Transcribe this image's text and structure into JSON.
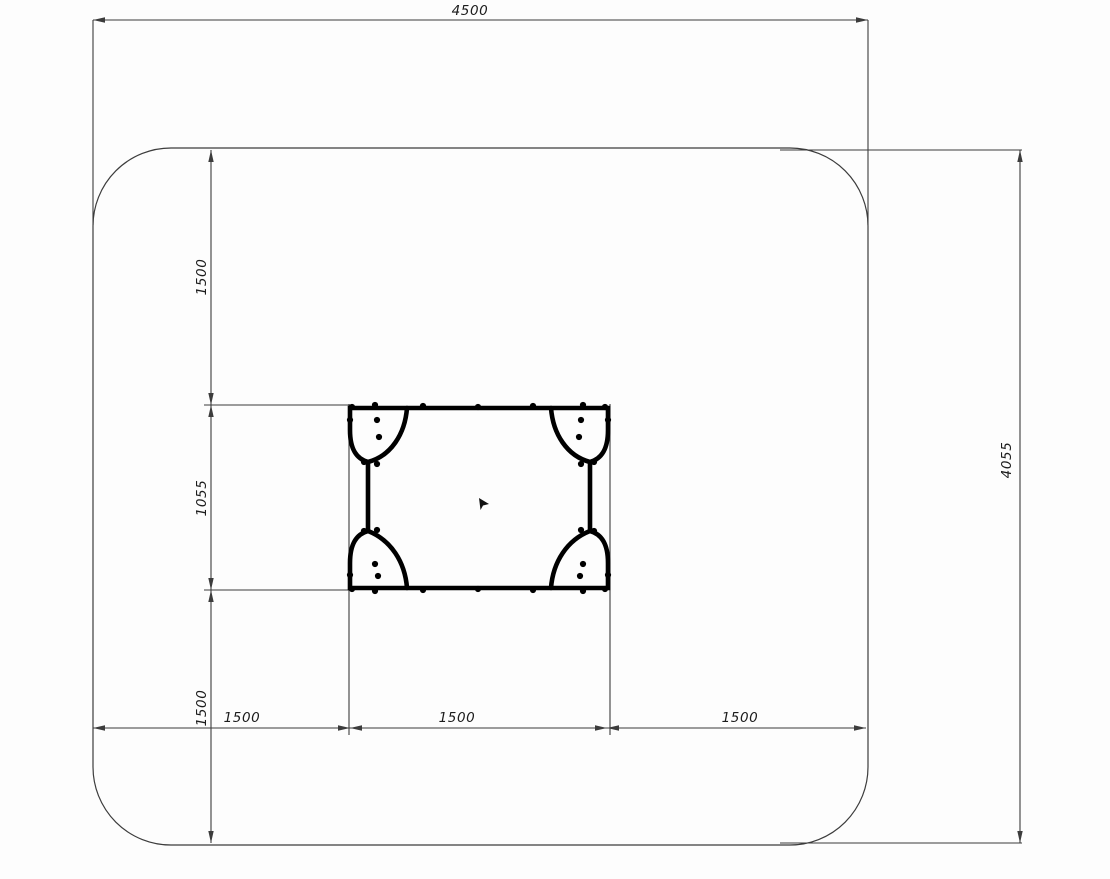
{
  "drawing": {
    "type": "technical-plan-drawing",
    "subject": "equipment-footprint-with-safety-zone",
    "dimensions": {
      "top": {
        "value": "4500"
      },
      "right": {
        "value": "4055"
      },
      "left_chain": [
        {
          "value": "1500"
        },
        {
          "value": "1055"
        },
        {
          "value": "1500"
        }
      ],
      "bottom_chain": [
        {
          "value": "1500"
        },
        {
          "value": "1500"
        },
        {
          "value": "1500"
        }
      ]
    },
    "colors": {
      "line": "#3c3c3c",
      "equipment": "#000000",
      "background": "#fdfdfd",
      "text": "#1c1c1c"
    },
    "equipment": {
      "bolt_points": [
        [
          352,
          407
        ],
        [
          375,
          405
        ],
        [
          423,
          406
        ],
        [
          478,
          407
        ],
        [
          533,
          406
        ],
        [
          583,
          405
        ],
        [
          605,
          407
        ],
        [
          350,
          420
        ],
        [
          608,
          420
        ],
        [
          377,
          420
        ],
        [
          379,
          437
        ],
        [
          581,
          420
        ],
        [
          579,
          437
        ],
        [
          364,
          462
        ],
        [
          377,
          464
        ],
        [
          594,
          462
        ],
        [
          581,
          464
        ],
        [
          364,
          531
        ],
        [
          377,
          530
        ],
        [
          594,
          531
        ],
        [
          581,
          530
        ],
        [
          375,
          564
        ],
        [
          378,
          576
        ],
        [
          583,
          564
        ],
        [
          580,
          576
        ],
        [
          350,
          575
        ],
        [
          608,
          575
        ],
        [
          352,
          589
        ],
        [
          375,
          591
        ],
        [
          423,
          590
        ],
        [
          478,
          589
        ],
        [
          533,
          590
        ],
        [
          583,
          591
        ],
        [
          605,
          589
        ]
      ]
    }
  }
}
